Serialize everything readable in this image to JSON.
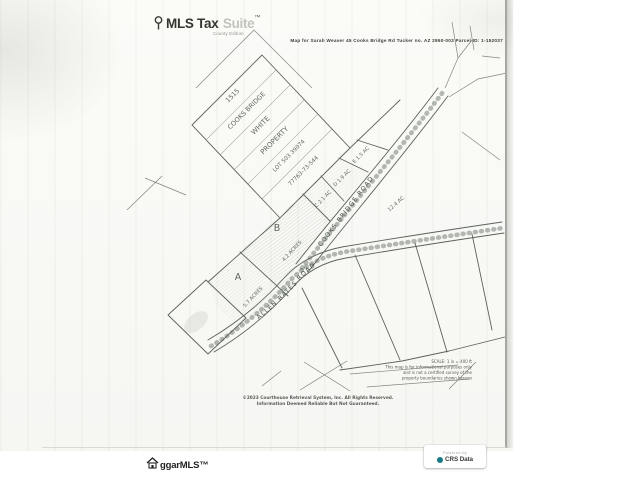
{
  "header": {
    "brand_name": "MLS Tax",
    "brand_suffix": "Suite",
    "brand_tm": "™",
    "brand_tagline": "County Edition",
    "map_title": "Map for Sarah Weaver 45 Cooks Bridge Rd Tucker no. AZ 2860-003 Parcel ID: 1-152037"
  },
  "map": {
    "big_parcel_lines": [
      "1515",
      "COOKS BRIDGE",
      "WHITE",
      "PROPERTY",
      "LOT 503 39074",
      "77763-73-544"
    ],
    "parcels": [
      {
        "id": "A",
        "acreage": "5.7 ACRES"
      },
      {
        "id": "B",
        "acreage": "4.2 ACRES"
      },
      {
        "id": "C",
        "acreage": "2.1 AC"
      },
      {
        "id": "D",
        "acreage": "1.9 AC"
      },
      {
        "id": "E",
        "acreage": "1.5 AC"
      }
    ],
    "wedge_acreage": "12.4 AC",
    "roads": [
      {
        "name": "COOKS BRIDGE ROAD"
      },
      {
        "name": "ALLEN BATES ROAD"
      }
    ],
    "notes": [
      "SCALE: 1 in = 400 ft",
      "This map is for informational purposes only",
      "and is not a certified survey of the",
      "property boundaries shown hereon"
    ],
    "copyright_line1": "©2023 Courthouse Retrieval System, Inc. All Rights Reserved.",
    "copyright_line2": "Information Deemed Reliable But Not Guaranteed."
  },
  "footer": {
    "mls_logo": "ggarMLS™",
    "badge_powered_by": "Powered by",
    "badge_vendor": "CRS Data"
  },
  "colors": {
    "ink": "#5b635a",
    "accent_teal": "#157a86"
  }
}
